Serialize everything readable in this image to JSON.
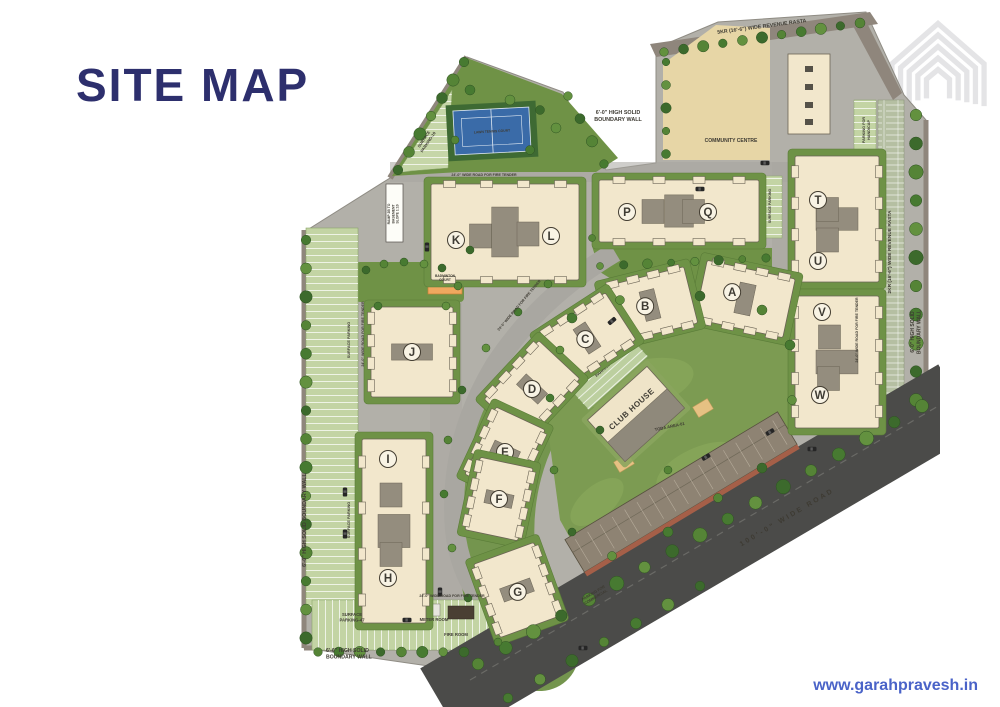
{
  "page": {
    "title": "SITE MAP",
    "website": "www.garahpravesh.in"
  },
  "colors": {
    "brand_navy": "#2d2f6d",
    "link_blue": "#4a63c8",
    "grass_green": "#7c9b52",
    "pavement_gray": "#b2b0a9",
    "building_cream": "#f2e7cc",
    "road_dark": "#4b4b49"
  },
  "map": {
    "towers": [
      "K",
      "L",
      "P",
      "Q",
      "T",
      "U",
      "V",
      "W",
      "A",
      "B",
      "C",
      "D",
      "E",
      "F",
      "G",
      "I",
      "H",
      "J"
    ],
    "roads": {
      "top": "5KR (16'-6\") WIDE REVENUE RASTA",
      "right": "2KR (16'-6\") WIDE REVENUE RASTA",
      "main": "100'-0\" WIDE ROAD",
      "fire_tender": "24'-0\" WIDE ROAD FOR FIRE TENDER"
    },
    "walls": {
      "nw": "6'-0\" HIGH SOLID BOUNDARY WALL",
      "left": "6'-0\" HIGH SOLID BOUNDARY WALL",
      "right": "6'-0\" HIGH SOLID BOUNDARY WALL",
      "bottom": "6'-6\" HIGH SOLID BOUNDARY WALL"
    },
    "amenities": {
      "community_centre": "COMMUNITY CENTRE",
      "club_house": "CLUB HOUSE",
      "tennis_court": "LAWN TENNIS COURT",
      "badminton_court": "BADMINTON COURT"
    },
    "parking": {
      "p10": "SURFACE PARKING-10",
      "p19": "SURFACE PARKING-19",
      "p47": "SURFACE PARKING-47",
      "left": "SURFACE PARKING",
      "right_pq": "SURFACE PARKING",
      "handicap": "PARKING FOR HANDICAP",
      "commercial": "PARKING FOR COMMERCIAL"
    },
    "rooms": {
      "meter": "METER ROOM",
      "fire": "FIRE ROOM"
    },
    "areas": {
      "toda": "TODA AREA-01"
    },
    "ramp": "RAMP 2B TO BASEMENT SLOPE 1:10"
  }
}
